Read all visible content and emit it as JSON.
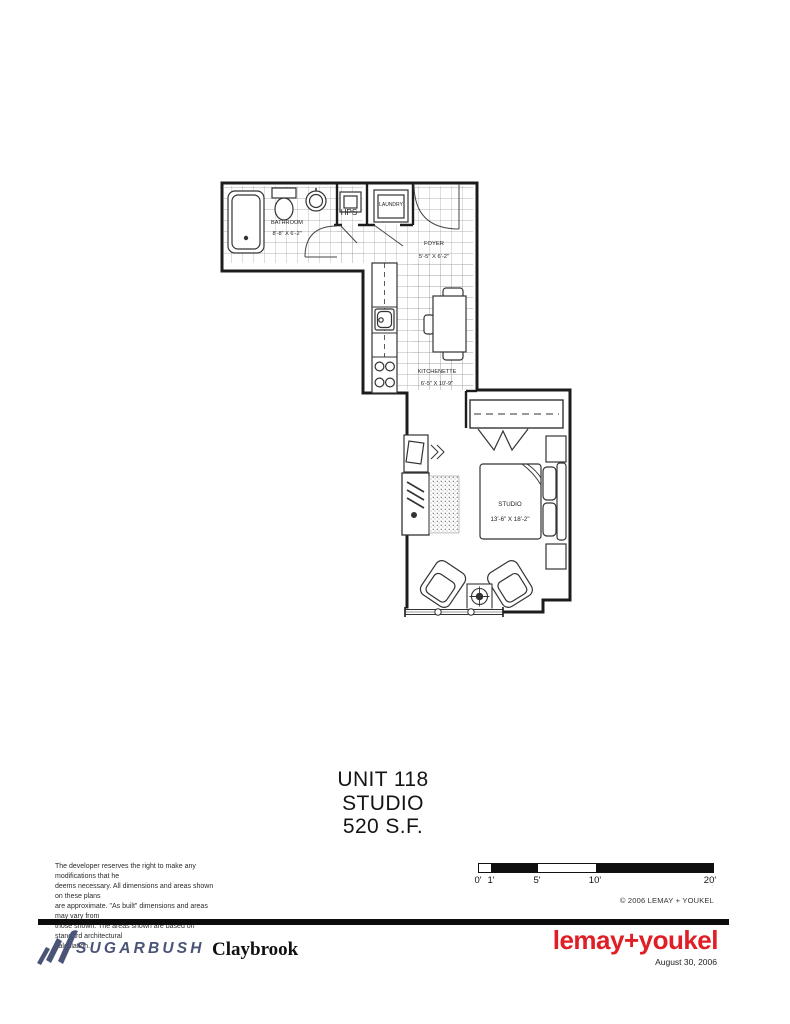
{
  "title": {
    "unit": "UNIT 118",
    "type": "STUDIO",
    "area": "520 S.F."
  },
  "plan": {
    "rooms": [
      {
        "name": "BATHROOM",
        "dims": "8'-8\" X 6'-2\""
      },
      {
        "name": "HPS",
        "dims": ""
      },
      {
        "name": "LAUNDRY",
        "dims": ""
      },
      {
        "name": "FOYER",
        "dims": "5'-5\" X 6'-2\""
      },
      {
        "name": "KITCHENETTE",
        "dims": "6'-5\" X 10'-9\""
      },
      {
        "name": "STUDIO",
        "dims": "13'-6\" X 18'-2\""
      }
    ]
  },
  "disclaimer": {
    "lines": [
      "The developer reserves the right to make any modifications that he",
      "deems necessary.  All dimensions and areas shown on these plans",
      "are approximate.  \"As built\" dimensions and areas may vary from",
      "those shown.  The areas shown are based on standard architectural",
      "calculation."
    ]
  },
  "scale_bar": {
    "labels": [
      "0'",
      "1'",
      "5'",
      "10'",
      "20'"
    ]
  },
  "copyright": "© 2006  LEMAY + YOUKEL",
  "footer": {
    "brand": "SUGARBUSH",
    "project": "Claybrook",
    "architect": "lemay+youkel",
    "date": "August 30, 2006"
  },
  "colors": {
    "brand_blue": "#4a5477",
    "architect_red": "#e01e26",
    "plan_line": "#1c1c1c",
    "tile_grid": "#9a9a9a"
  }
}
